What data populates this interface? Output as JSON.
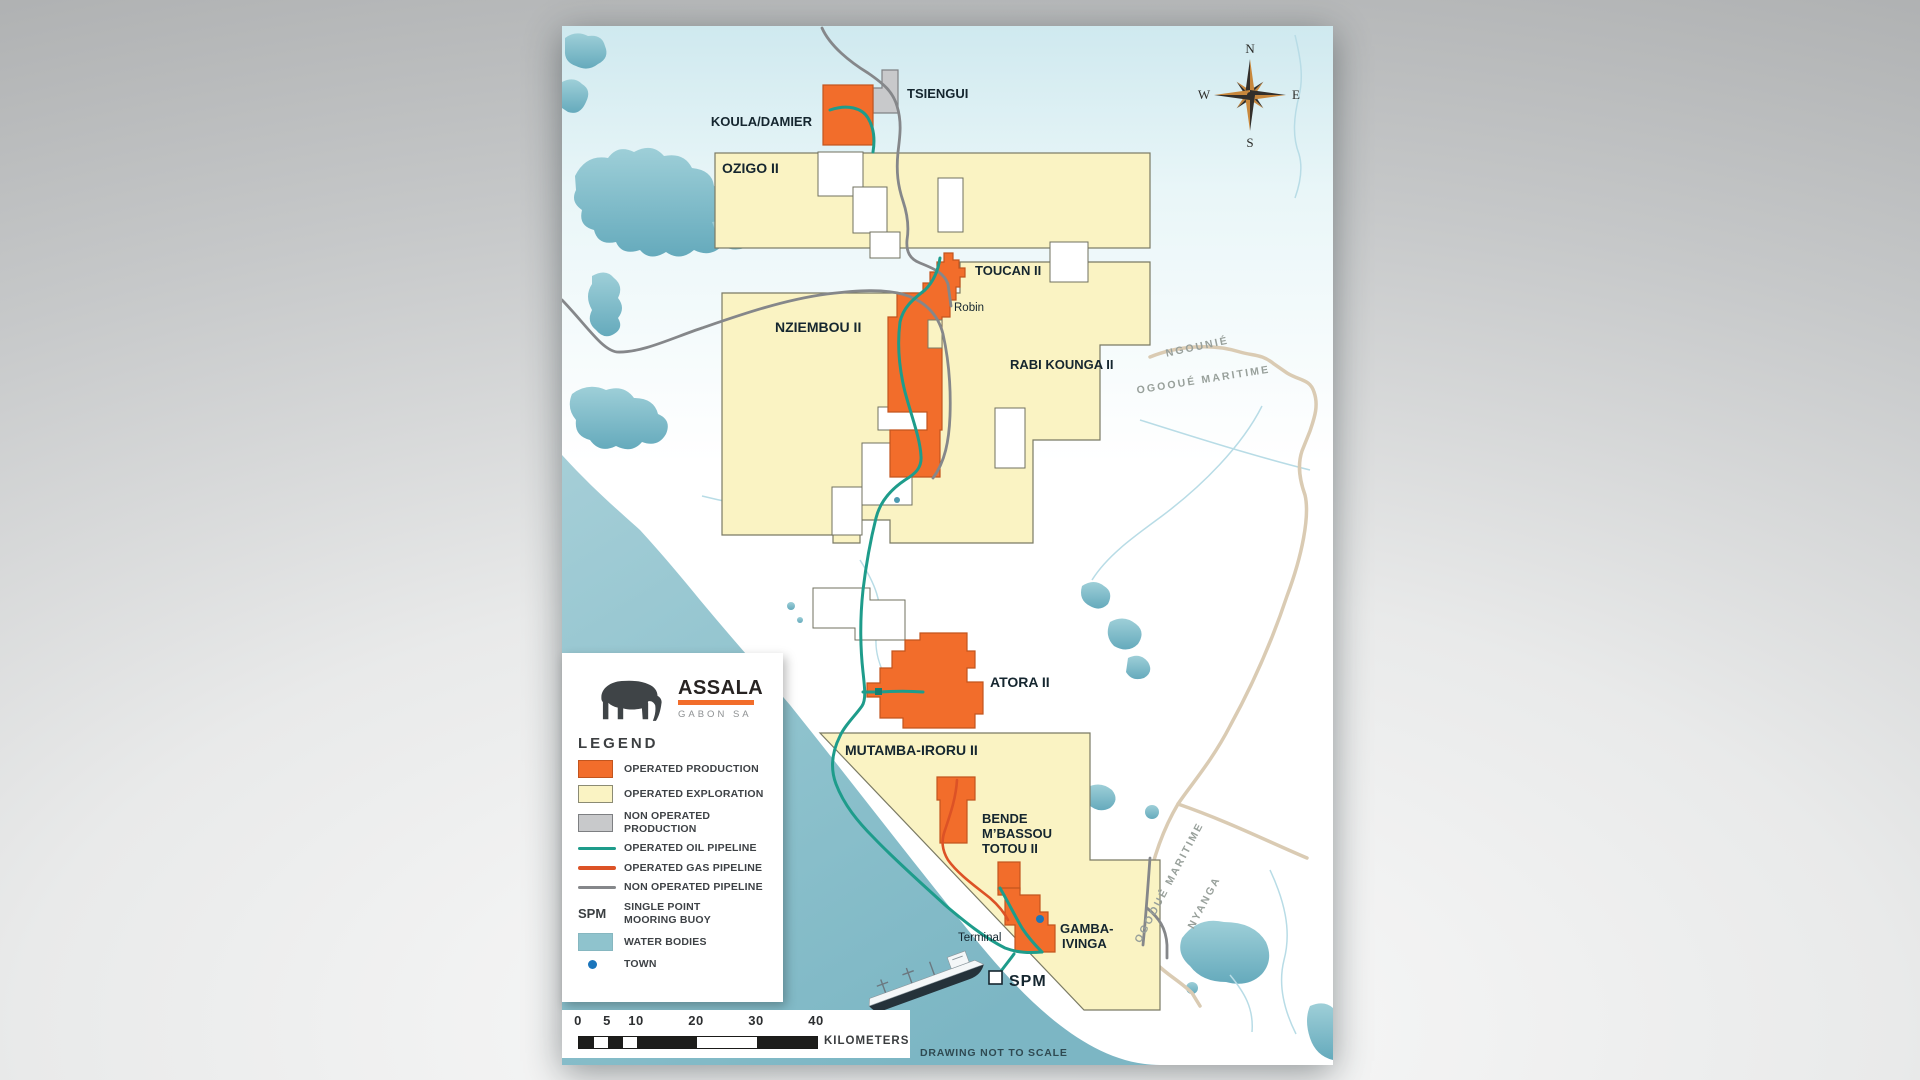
{
  "logo": {
    "brand": "ASSALA",
    "subtitle": "GABON SA",
    "bar_color": "#F26D2B"
  },
  "legend": {
    "heading": "LEGEND",
    "items": [
      {
        "type": "swatch",
        "label": "OPERATED PRODUCTION",
        "color": "#F26D2B",
        "border": "#C2551E"
      },
      {
        "type": "swatch",
        "label": "OPERATED EXPLORATION",
        "color": "#FAF3C3",
        "border": "#8B8B74"
      },
      {
        "type": "swatch",
        "label": "NON OPERATED\nPRODUCTION",
        "color": "#C8C9CB",
        "border": "#7D7F82"
      },
      {
        "type": "line",
        "label": "OPERATED OIL PIPELINE",
        "color": "#1E9C8B"
      },
      {
        "type": "line",
        "label": "OPERATED GAS PIPELINE",
        "color": "#DC5226"
      },
      {
        "type": "line",
        "label": "NON OPERATED PIPELINE",
        "color": "#85878A"
      },
      {
        "type": "text",
        "symbol": "SPM",
        "label": "SINGLE POINT\nMOORING BUOY"
      },
      {
        "type": "swatch",
        "label": "WATER BODIES",
        "color": "#8FC3CD",
        "border": "#86B7C0"
      },
      {
        "type": "dot",
        "label": "TOWN",
        "color": "#1B75BB"
      }
    ]
  },
  "scalebar": {
    "ticks": [
      {
        "label": "0",
        "x": 16
      },
      {
        "label": "5",
        "x": 45
      },
      {
        "label": "10",
        "x": 74
      },
      {
        "label": "20",
        "x": 134
      },
      {
        "label": "30",
        "x": 194
      },
      {
        "label": "40",
        "x": 254
      }
    ],
    "segments": [
      {
        "w": 14.5,
        "c": "#1d1d1b"
      },
      {
        "w": 14.5,
        "c": "#ffffff"
      },
      {
        "w": 14.5,
        "c": "#1d1d1b"
      },
      {
        "w": 14.5,
        "c": "#ffffff"
      },
      {
        "w": 60,
        "c": "#1d1d1b"
      },
      {
        "w": 60,
        "c": "#ffffff"
      },
      {
        "w": 60,
        "c": "#1d1d1b"
      }
    ],
    "unit": "KILOMETERS"
  },
  "compass": {
    "n": "N",
    "e": "E",
    "s": "S",
    "w": "W"
  },
  "map_labels": {
    "tsiengui": "TSIENGUI",
    "koula_damier": "KOULA/DAMIER",
    "ozigo": "OZIGO II",
    "toucan": "TOUCAN II",
    "robin": "Robin",
    "nziembou": "NZIEMBOU II",
    "rabi_kounga": "RABI KOUNGA II",
    "atora": "ATORA II",
    "mutamba": "MUTAMBA-IRORU II",
    "bende_1": "BENDE",
    "bende_2": "M’BASSOU",
    "bende_3": "TOTOU II",
    "gamba_1": "GAMBA-",
    "gamba_2": "IVINGA",
    "terminal": "Terminal",
    "spm": "SPM",
    "note": "DRAWING NOT TO SCALE",
    "ngounie": "NGOUNIÉ",
    "ogooue_maritime": "OGOOUÉ MARITIME",
    "nyanga": "NYANGA"
  },
  "colors": {
    "operated_production": "#F26D2B",
    "operated_exploration": "#FAF3C3",
    "non_operated_production": "#C8C9CB",
    "oil_pipeline": "#1E9C8B",
    "gas_pipeline": "#DC5226",
    "non_operated_pipeline": "#85878A",
    "water": "#8FC3CD",
    "town": "#1B75BB",
    "boundary": "#DACBB3"
  }
}
